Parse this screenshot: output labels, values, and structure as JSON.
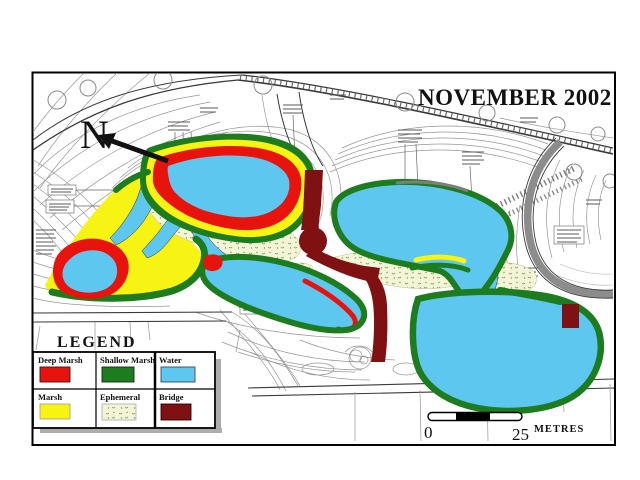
{
  "map": {
    "title": "NOVEMBER 2002",
    "north_label": "N",
    "type": "wetland habitat plan"
  },
  "legend": {
    "title": "LEGEND",
    "items": [
      {
        "label": "Deep Marsh",
        "color": "#e8130c",
        "swatch": "solid"
      },
      {
        "label": "Shallow Marsh",
        "color": "#1d7c1d",
        "swatch": "solid"
      },
      {
        "label": "Water",
        "color": "#5ec7ef",
        "swatch": "solid"
      },
      {
        "label": "Marsh",
        "color": "#f7f312",
        "swatch": "solid"
      },
      {
        "label": "Ephemeral",
        "color": "#f3f5d6",
        "swatch": "pattern"
      },
      {
        "label": "Bridge",
        "color": "#7f1113",
        "swatch": "solid"
      }
    ]
  },
  "scale_bar": {
    "zero_label": "0",
    "distance_label": "25",
    "unit_label": "METRES"
  },
  "palette": {
    "frame": "#000000",
    "background": "#ffffff",
    "contour_gray": "#979797",
    "road_gray": "#8c8c8c"
  }
}
